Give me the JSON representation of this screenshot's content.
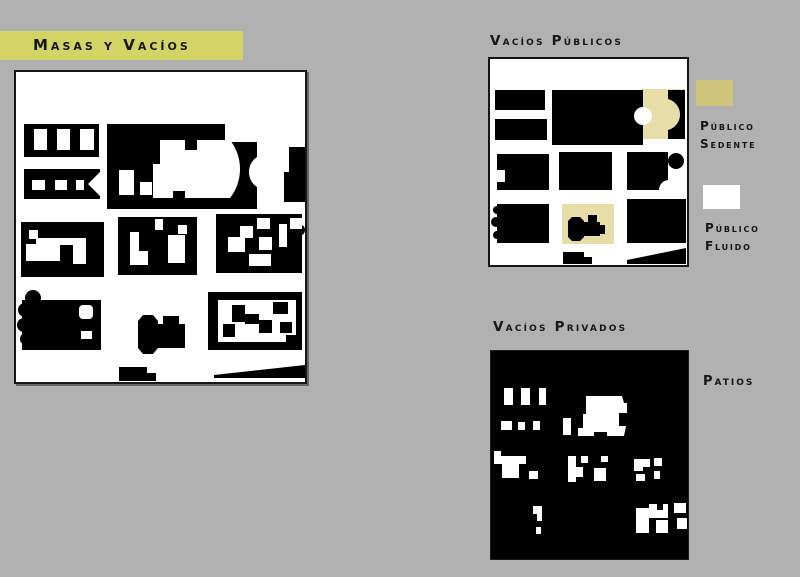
{
  "canvas": {
    "background": "#b1b1b1"
  },
  "title_banner": {
    "label": "Masas y Vacíos",
    "bg": "#d4d465",
    "fg": "#161616"
  },
  "sections": {
    "publicos_label": "Vacíos Públicos",
    "privados_label": "Vacíos Privados"
  },
  "legend": {
    "sedente": {
      "swatch_color": "#cfc47c",
      "line1": "Público",
      "line2": "Sedente"
    },
    "fluido": {
      "swatch_color": "#ffffff",
      "line1": "Público",
      "line2": "Fluido"
    },
    "patios_label": "Patios"
  },
  "colors": {
    "ink": "#000000",
    "paper": "#ffffff",
    "highlight": "#e6dea6"
  },
  "maps": {
    "masas": {
      "w": 289,
      "h": 310,
      "bg": "#ffffff",
      "shapes": [
        {
          "t": "rect",
          "x": 8,
          "y": 52,
          "w": 75,
          "h": 33,
          "f": "#000"
        },
        {
          "t": "rect",
          "x": 18,
          "y": 57,
          "w": 13,
          "h": 21,
          "f": "#fff"
        },
        {
          "t": "rect",
          "x": 41,
          "y": 57,
          "w": 13,
          "h": 21,
          "f": "#fff"
        },
        {
          "t": "rect",
          "x": 64,
          "y": 57,
          "w": 14,
          "h": 21,
          "f": "#fff"
        },
        {
          "t": "rect",
          "x": 8,
          "y": 97,
          "w": 76,
          "h": 30,
          "f": "#000"
        },
        {
          "t": "rect",
          "x": 16,
          "y": 108,
          "w": 13,
          "h": 10,
          "f": "#fff"
        },
        {
          "t": "rect",
          "x": 39,
          "y": 108,
          "w": 12,
          "h": 10,
          "f": "#fff"
        },
        {
          "t": "rect",
          "x": 60,
          "y": 108,
          "w": 8,
          "h": 10,
          "f": "#fff"
        },
        {
          "t": "polygon",
          "pts": "84,100 72,112 84,124",
          "f": "#fff"
        },
        {
          "t": "rect",
          "x": 91,
          "y": 52,
          "w": 150,
          "h": 85,
          "f": "#000"
        },
        {
          "t": "rect",
          "x": 209,
          "y": 52,
          "w": 32,
          "h": 18,
          "f": "#fff"
        },
        {
          "t": "path",
          "d": "M144,68 H169 V78 H181 V68 H214 A47,47 0 0 1 214,126 H169 V119 H157 V126 H137 V92 H144 Z",
          "f": "#fff"
        },
        {
          "t": "rect",
          "x": 103,
          "y": 98,
          "w": 15,
          "h": 25,
          "f": "#fff"
        },
        {
          "t": "rect",
          "x": 124,
          "y": 110,
          "w": 12,
          "h": 13,
          "f": "#fff"
        },
        {
          "t": "path",
          "d": "M241,85 A18,18 0 0 0 241,115 Z",
          "f": "#fff"
        },
        {
          "t": "rect",
          "x": 273,
          "y": 75,
          "w": 16,
          "h": 55,
          "f": "#000"
        },
        {
          "t": "rect",
          "x": 268,
          "y": 100,
          "w": 5,
          "h": 30,
          "f": "#000"
        },
        {
          "t": "circle",
          "cx": 283,
          "cy": 158,
          "r": 6,
          "f": "#000"
        },
        {
          "t": "rect",
          "x": 5,
          "y": 150,
          "w": 83,
          "h": 55,
          "f": "#000"
        },
        {
          "t": "rect",
          "x": 13,
          "y": 158,
          "w": 9,
          "h": 9,
          "f": "#fff"
        },
        {
          "t": "rect",
          "x": 20,
          "y": 166,
          "w": 50,
          "h": 23,
          "f": "#fff"
        },
        {
          "t": "rect",
          "x": 10,
          "y": 172,
          "w": 10,
          "h": 17,
          "f": "#fff"
        },
        {
          "t": "rect",
          "x": 57,
          "y": 175,
          "w": 13,
          "h": 17,
          "f": "#fff"
        },
        {
          "t": "rect",
          "x": 44,
          "y": 173,
          "w": 13,
          "h": 16,
          "f": "#000"
        },
        {
          "t": "rect",
          "x": 102,
          "y": 145,
          "w": 79,
          "h": 58,
          "f": "#000"
        },
        {
          "t": "rect",
          "x": 114,
          "y": 160,
          "w": 9,
          "h": 33,
          "f": "#fff"
        },
        {
          "t": "rect",
          "x": 123,
          "y": 179,
          "w": 9,
          "h": 14,
          "f": "#fff"
        },
        {
          "t": "rect",
          "x": 139,
          "y": 147,
          "w": 8,
          "h": 11,
          "f": "#fff"
        },
        {
          "t": "rect",
          "x": 152,
          "y": 163,
          "w": 17,
          "h": 28,
          "f": "#fff"
        },
        {
          "t": "rect",
          "x": 162,
          "y": 153,
          "w": 9,
          "h": 9,
          "f": "#fff"
        },
        {
          "t": "rect",
          "x": 200,
          "y": 142,
          "w": 86,
          "h": 59,
          "f": "#000"
        },
        {
          "t": "rect",
          "x": 212,
          "y": 165,
          "w": 17,
          "h": 15,
          "f": "#fff"
        },
        {
          "t": "rect",
          "x": 224,
          "y": 154,
          "w": 13,
          "h": 12,
          "f": "#fff"
        },
        {
          "t": "rect",
          "x": 241,
          "y": 146,
          "w": 13,
          "h": 11,
          "f": "#fff"
        },
        {
          "t": "rect",
          "x": 243,
          "y": 165,
          "w": 13,
          "h": 13,
          "f": "#fff"
        },
        {
          "t": "rect",
          "x": 233,
          "y": 182,
          "w": 22,
          "h": 12,
          "f": "#fff"
        },
        {
          "t": "rect",
          "x": 263,
          "y": 152,
          "w": 8,
          "h": 23,
          "f": "#fff"
        },
        {
          "t": "rect",
          "x": 274,
          "y": 146,
          "w": 12,
          "h": 11,
          "f": "#fff"
        },
        {
          "t": "rect",
          "x": 6,
          "y": 228,
          "w": 79,
          "h": 50,
          "f": "#000"
        },
        {
          "t": "circle",
          "cx": 17,
          "cy": 226,
          "r": 8,
          "f": "#000"
        },
        {
          "t": "circle",
          "cx": 9,
          "cy": 238,
          "r": 7,
          "f": "#000"
        },
        {
          "t": "circle",
          "cx": 8,
          "cy": 253,
          "r": 7,
          "f": "#000"
        },
        {
          "t": "circle",
          "cx": 10,
          "cy": 267,
          "r": 6,
          "f": "#000"
        },
        {
          "t": "rect",
          "x": 63,
          "y": 233,
          "w": 14,
          "h": 14,
          "rx": 4,
          "f": "#fff"
        },
        {
          "t": "rect",
          "x": 65,
          "y": 259,
          "w": 11,
          "h": 8,
          "f": "#fff"
        },
        {
          "t": "path",
          "d": "M127,243 H137 L142,249 V276 L137,282 H127 L122,276 V249 Z",
          "f": "#000"
        },
        {
          "t": "rect",
          "x": 142,
          "y": 252,
          "w": 27,
          "h": 24,
          "f": "#000"
        },
        {
          "t": "rect",
          "x": 147,
          "y": 244,
          "w": 16,
          "h": 8,
          "f": "#000"
        },
        {
          "t": "rect",
          "x": 192,
          "y": 220,
          "w": 94,
          "h": 58,
          "f": "#000"
        },
        {
          "t": "rect",
          "x": 202,
          "y": 228,
          "w": 78,
          "h": 42,
          "f": "#fff"
        },
        {
          "t": "rect",
          "x": 216,
          "y": 233,
          "w": 13,
          "h": 17,
          "f": "#000"
        },
        {
          "t": "rect",
          "x": 229,
          "y": 242,
          "w": 14,
          "h": 10,
          "f": "#000"
        },
        {
          "t": "rect",
          "x": 243,
          "y": 248,
          "w": 13,
          "h": 13,
          "f": "#000"
        },
        {
          "t": "rect",
          "x": 257,
          "y": 230,
          "w": 15,
          "h": 12,
          "f": "#000"
        },
        {
          "t": "rect",
          "x": 264,
          "y": 250,
          "w": 12,
          "h": 11,
          "f": "#000"
        },
        {
          "t": "rect",
          "x": 207,
          "y": 252,
          "w": 12,
          "h": 13,
          "f": "#000"
        },
        {
          "t": "rect",
          "x": 270,
          "y": 263,
          "w": 10,
          "h": 7,
          "f": "#000"
        },
        {
          "t": "rect",
          "x": 103,
          "y": 295,
          "w": 28,
          "h": 14,
          "f": "#000"
        },
        {
          "t": "rect",
          "x": 131,
          "y": 301,
          "w": 9,
          "h": 8,
          "f": "#000"
        },
        {
          "t": "polygon",
          "pts": "198,303 289,293 289,306 198,306",
          "f": "#000"
        }
      ]
    },
    "publicos": {
      "w": 197,
      "h": 206,
      "bg": "#ffffff",
      "shapes": [
        {
          "t": "rect",
          "x": 150,
          "y": 30,
          "w": 45,
          "h": 50,
          "f": "#e6dea6"
        },
        {
          "t": "rect",
          "x": 5,
          "y": 31,
          "w": 50,
          "h": 20,
          "f": "#000"
        },
        {
          "t": "rect",
          "x": 5,
          "y": 60,
          "w": 52,
          "h": 21,
          "f": "#000"
        },
        {
          "t": "rect",
          "x": 62,
          "y": 31,
          "w": 91,
          "h": 55,
          "f": "#000"
        },
        {
          "t": "circle",
          "cx": 153,
          "cy": 57,
          "r": 9,
          "f": "#fff"
        },
        {
          "t": "path",
          "d": "M178,31 H195 V80 H178 V71 A16,16 0 0 0 178,40 Z",
          "f": "#000"
        },
        {
          "t": "rect",
          "x": 7,
          "y": 95,
          "w": 52,
          "h": 36,
          "f": "#000"
        },
        {
          "t": "rect",
          "x": 7,
          "y": 111,
          "w": 8,
          "h": 12,
          "f": "#fff"
        },
        {
          "t": "rect",
          "x": 69,
          "y": 93,
          "w": 53,
          "h": 38,
          "f": "#000"
        },
        {
          "t": "rect",
          "x": 137,
          "y": 93,
          "w": 41,
          "h": 38,
          "f": "#000"
        },
        {
          "t": "circle",
          "cx": 186,
          "cy": 102,
          "r": 8,
          "f": "#000"
        },
        {
          "t": "circle",
          "cx": 179,
          "cy": 131,
          "r": 10,
          "f": "#fff"
        },
        {
          "t": "rect",
          "x": 7,
          "y": 145,
          "w": 52,
          "h": 39,
          "f": "#000"
        },
        {
          "t": "circle",
          "cx": 7,
          "cy": 151,
          "r": 4,
          "f": "#000"
        },
        {
          "t": "circle",
          "cx": 6,
          "cy": 163,
          "r": 5,
          "f": "#000"
        },
        {
          "t": "circle",
          "cx": 7,
          "cy": 176,
          "r": 4,
          "f": "#000"
        },
        {
          "t": "rect",
          "x": 72,
          "y": 145,
          "w": 52,
          "h": 40,
          "f": "#e6dea6"
        },
        {
          "t": "path",
          "d": "M82,158 H90 L94,162 V178 L90,182 H82 L78,178 V162 Z",
          "f": "#000"
        },
        {
          "t": "rect",
          "x": 94,
          "y": 163,
          "w": 16,
          "h": 14,
          "f": "#000"
        },
        {
          "t": "rect",
          "x": 98,
          "y": 156,
          "w": 9,
          "h": 8,
          "f": "#000"
        },
        {
          "t": "rect",
          "x": 110,
          "y": 166,
          "w": 5,
          "h": 9,
          "f": "#000"
        },
        {
          "t": "rect",
          "x": 137,
          "y": 140,
          "w": 59,
          "h": 44,
          "f": "#000"
        },
        {
          "t": "rect",
          "x": 73,
          "y": 193,
          "w": 21,
          "h": 12,
          "f": "#000"
        },
        {
          "t": "rect",
          "x": 94,
          "y": 198,
          "w": 8,
          "h": 7,
          "f": "#000"
        },
        {
          "t": "polygon",
          "pts": "137,201 196,189 196,205 137,205",
          "f": "#000"
        }
      ]
    },
    "privados": {
      "w": 197,
      "h": 208,
      "bg": "#000000",
      "shapes": [
        {
          "t": "rect",
          "x": 13,
          "y": 37,
          "w": 9,
          "h": 17,
          "f": "#fff"
        },
        {
          "t": "rect",
          "x": 30,
          "y": 37,
          "w": 9,
          "h": 17,
          "f": "#fff"
        },
        {
          "t": "rect",
          "x": 48,
          "y": 37,
          "w": 7,
          "h": 17,
          "f": "#fff"
        },
        {
          "t": "rect",
          "x": 10,
          "y": 70,
          "w": 11,
          "h": 9,
          "f": "#fff"
        },
        {
          "t": "rect",
          "x": 27,
          "y": 71,
          "w": 7,
          "h": 8,
          "f": "#fff"
        },
        {
          "t": "rect",
          "x": 42,
          "y": 70,
          "w": 7,
          "h": 9,
          "f": "#fff"
        },
        {
          "t": "rect",
          "x": 72,
          "y": 67,
          "w": 8,
          "h": 17,
          "f": "#fff"
        },
        {
          "t": "rect",
          "x": 87,
          "y": 77,
          "w": 5,
          "h": 8,
          "f": "#fff"
        },
        {
          "t": "path",
          "d": "M95,45 H131 L133,52 H136 V62 H128 V75 H135 L133,85 H116 V81 H103 V85 H92 V63 H95 Z",
          "f": "#fff"
        },
        {
          "t": "path",
          "d": "M3,105 H35 V113 H28 V127 H11 V113 H3 Z",
          "f": "#fff"
        },
        {
          "t": "rect",
          "x": 3,
          "y": 100,
          "w": 7,
          "h": 5,
          "f": "#fff"
        },
        {
          "t": "rect",
          "x": 38,
          "y": 120,
          "w": 9,
          "h": 8,
          "f": "#fff"
        },
        {
          "t": "rect",
          "x": 77,
          "y": 105,
          "w": 8,
          "h": 26,
          "f": "#fff"
        },
        {
          "t": "rect",
          "x": 85,
          "y": 116,
          "w": 7,
          "h": 10,
          "f": "#fff"
        },
        {
          "t": "rect",
          "x": 90,
          "y": 105,
          "w": 7,
          "h": 7,
          "f": "#fff"
        },
        {
          "t": "rect",
          "x": 103,
          "y": 117,
          "w": 12,
          "h": 13,
          "f": "#fff"
        },
        {
          "t": "rect",
          "x": 110,
          "y": 105,
          "w": 7,
          "h": 6,
          "f": "#fff"
        },
        {
          "t": "rect",
          "x": 143,
          "y": 108,
          "w": 9,
          "h": 12,
          "f": "#fff"
        },
        {
          "t": "rect",
          "x": 152,
          "y": 108,
          "w": 7,
          "h": 8,
          "f": "#fff"
        },
        {
          "t": "rect",
          "x": 163,
          "y": 107,
          "w": 8,
          "h": 8,
          "f": "#fff"
        },
        {
          "t": "rect",
          "x": 145,
          "y": 123,
          "w": 9,
          "h": 7,
          "f": "#fff"
        },
        {
          "t": "rect",
          "x": 163,
          "y": 120,
          "w": 6,
          "h": 8,
          "f": "#fff"
        },
        {
          "t": "path",
          "d": "M42,155 H51 V170 H46 V163 H42 Z",
          "f": "#fff"
        },
        {
          "t": "rect",
          "x": 45,
          "y": 176,
          "w": 5,
          "h": 7,
          "f": "#fff"
        },
        {
          "t": "rect",
          "x": 145,
          "y": 157,
          "w": 13,
          "h": 25,
          "f": "#fff"
        },
        {
          "t": "rect",
          "x": 158,
          "y": 153,
          "w": 19,
          "h": 14,
          "f": "#fff"
        },
        {
          "t": "rect",
          "x": 166,
          "y": 153,
          "w": 6,
          "h": 6,
          "f": "#000"
        },
        {
          "t": "rect",
          "x": 165,
          "y": 169,
          "w": 12,
          "h": 13,
          "f": "#fff"
        },
        {
          "t": "rect",
          "x": 183,
          "y": 152,
          "w": 12,
          "h": 10,
          "f": "#fff"
        },
        {
          "t": "rect",
          "x": 186,
          "y": 167,
          "w": 10,
          "h": 11,
          "f": "#fff"
        }
      ]
    }
  }
}
